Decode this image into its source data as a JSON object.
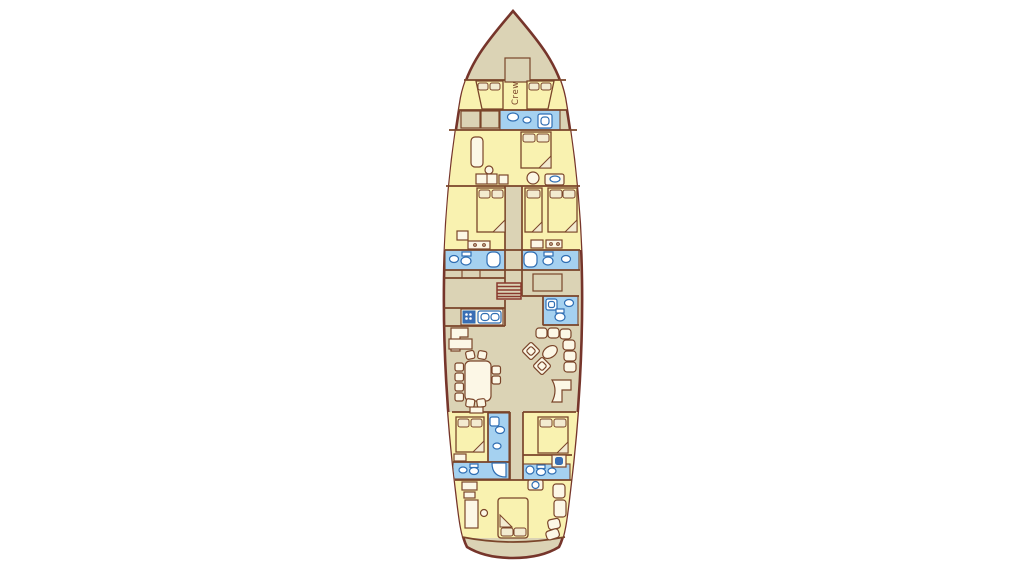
{
  "labels": {
    "crew_cabin": "Crew"
  },
  "colors": {
    "background": "#ffffff",
    "hull_outline": "#76352b",
    "deck": "#dbd3b5",
    "cabin": "#f9f2b0",
    "bath": "#a5d1f0",
    "wall": "#7a452a",
    "furniture_fill": "#fcf7e6",
    "pillow_fill": "#f3ebd0",
    "fixture": "#2f6eb3",
    "stove": "#3b6db4",
    "stairs": "#8a3a2e"
  }
}
